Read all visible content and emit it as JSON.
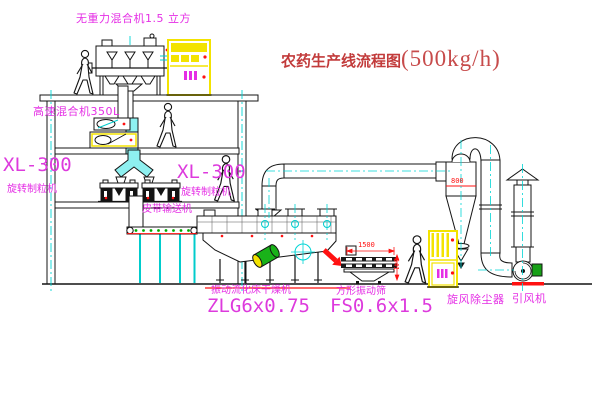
{
  "title": {
    "name": "农药生产线流程图",
    "capacity": "(500kg/h)"
  },
  "labels": {
    "gravity_mixer": "无重力混合机1.5 立方",
    "high_speed_mixer": "高速混合机350L",
    "granulator_left": {
      "model": "XL-300",
      "name": "旋转制粒机"
    },
    "granulator_right": {
      "model": "XL-300",
      "name": "旋转制粒机"
    },
    "belt_conveyor": "皮带输送机",
    "dryer": {
      "name": "振动流化床干燥机",
      "model": "ZLG6x0.75"
    },
    "sieve": {
      "name": "方形振动筛",
      "model": "FS0.6x1.5"
    },
    "cyclone": "旋风除尘器",
    "fan": "引风机"
  },
  "dimensions": {
    "sieve_length": "1500",
    "sieve_drop": "541",
    "cyclone_size": "800"
  },
  "colors": {
    "label_magenta": "#e52ee5",
    "title_red": "#c23b3b",
    "dim_red": "#ff1111",
    "centerline_cyan": "#00d5d5",
    "cabinet_yellow": "#f3e300",
    "machine_green": "#17a017",
    "chute_cyan": "#8ef0f0",
    "line_black": "#141414"
  }
}
